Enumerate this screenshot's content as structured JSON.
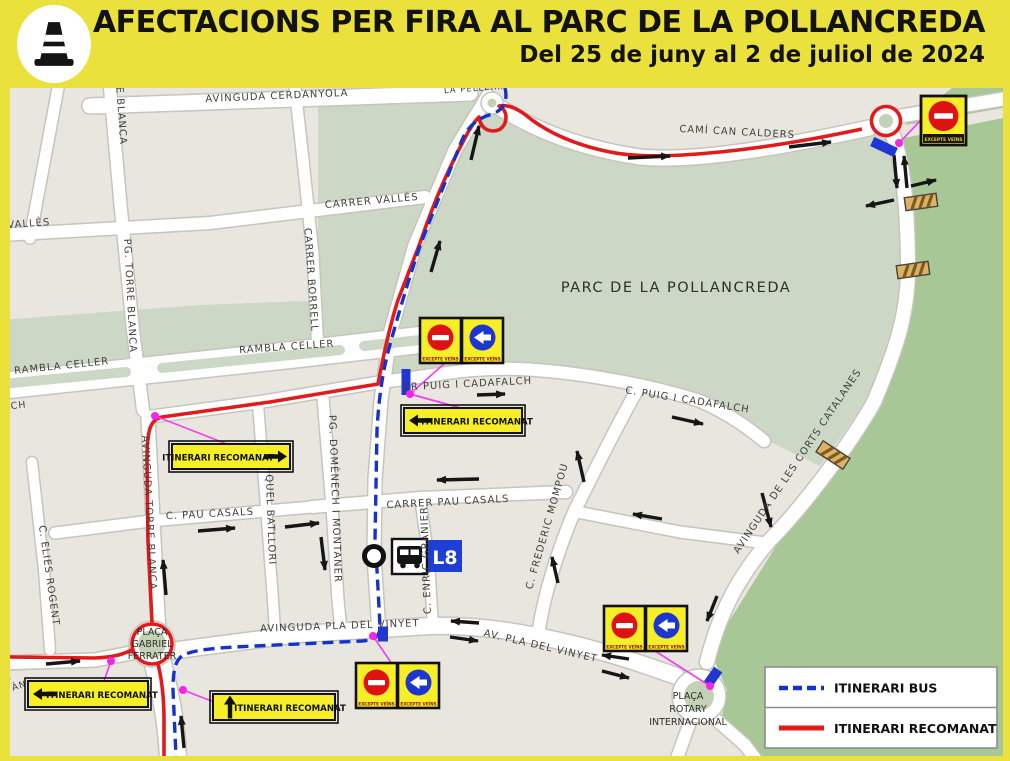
{
  "header": {
    "title": "AFECTACIONS PER FIRA AL PARC DE LA POLLANCREDA",
    "subtitle": "Del 25 de juny al 2 de juliol de 2024"
  },
  "legend": {
    "bus_label": "ITINERARI BUS",
    "recomanat_label": "ITINERARI RECOMANAT"
  },
  "labels": {
    "route_label": "ITINERARI RECOMANAT"
  },
  "signs": {
    "fine_print": "EXCEPTE VEÏNS"
  },
  "transit": {
    "bus_line": "L8"
  },
  "places": {
    "park": "PARC DE LA POLLANCREDA",
    "ferrater": [
      "PLAÇA",
      "GABRIEL",
      "FERRATER"
    ],
    "rotary": [
      "PLAÇA",
      "ROTARY",
      "INTERNACIONAL"
    ]
  },
  "streets": {
    "cerdanyola": "AVINGUDA CERDANYOLA",
    "pelleria": "LA PELLERIA",
    "calders": "CAMÍ CAN CALDERS",
    "valles_partial": "R VALLÈS",
    "valles": "CARRER VALLÈS",
    "torre_blanca_partial": "RE BLANCA",
    "pg_torre_blanca": "PG. TORRE BLANCA",
    "borrell": "CARRER BORRELL",
    "rambla1": "RAMBLA CELLER",
    "rambla2": "RAMBLA CELLER",
    "puig_w": "ER PUIG I CADAFALCH",
    "puig_e": "C. PUIG I CADAFALCH",
    "corts": "AVINGUDA DE LES CORTS CATALANES",
    "alch": "ALCH",
    "av_torre_blanca": "AVINGUDA TORRE BLANCA",
    "elies": "C. ELIES ROGENT",
    "pau_w": "C. PAU CASALS",
    "domenech": "PG. DOMÈNECH I MONTANER",
    "batllori": "C. MIQUEL BATLLORI",
    "pau_e": "CARRER PAU CASALS",
    "granier": "C. ENRIC GRANIER",
    "mompou": "C. FREDERIC MOMPOU",
    "vinyet1": "AVINGUDA PLA DEL VINYET",
    "vinyet2": "AV. PLA DEL VINYET",
    "partial_a": "A",
    "partial_san": "S ÀN"
  },
  "colors": {
    "header_bg": "#eae13c",
    "bus_route": "#1433cc",
    "recomanat_route": "#e31a1c",
    "sign_yellow": "#f6ee27",
    "park_green": "#ccd8c5",
    "outer_green": "#a8c796"
  }
}
